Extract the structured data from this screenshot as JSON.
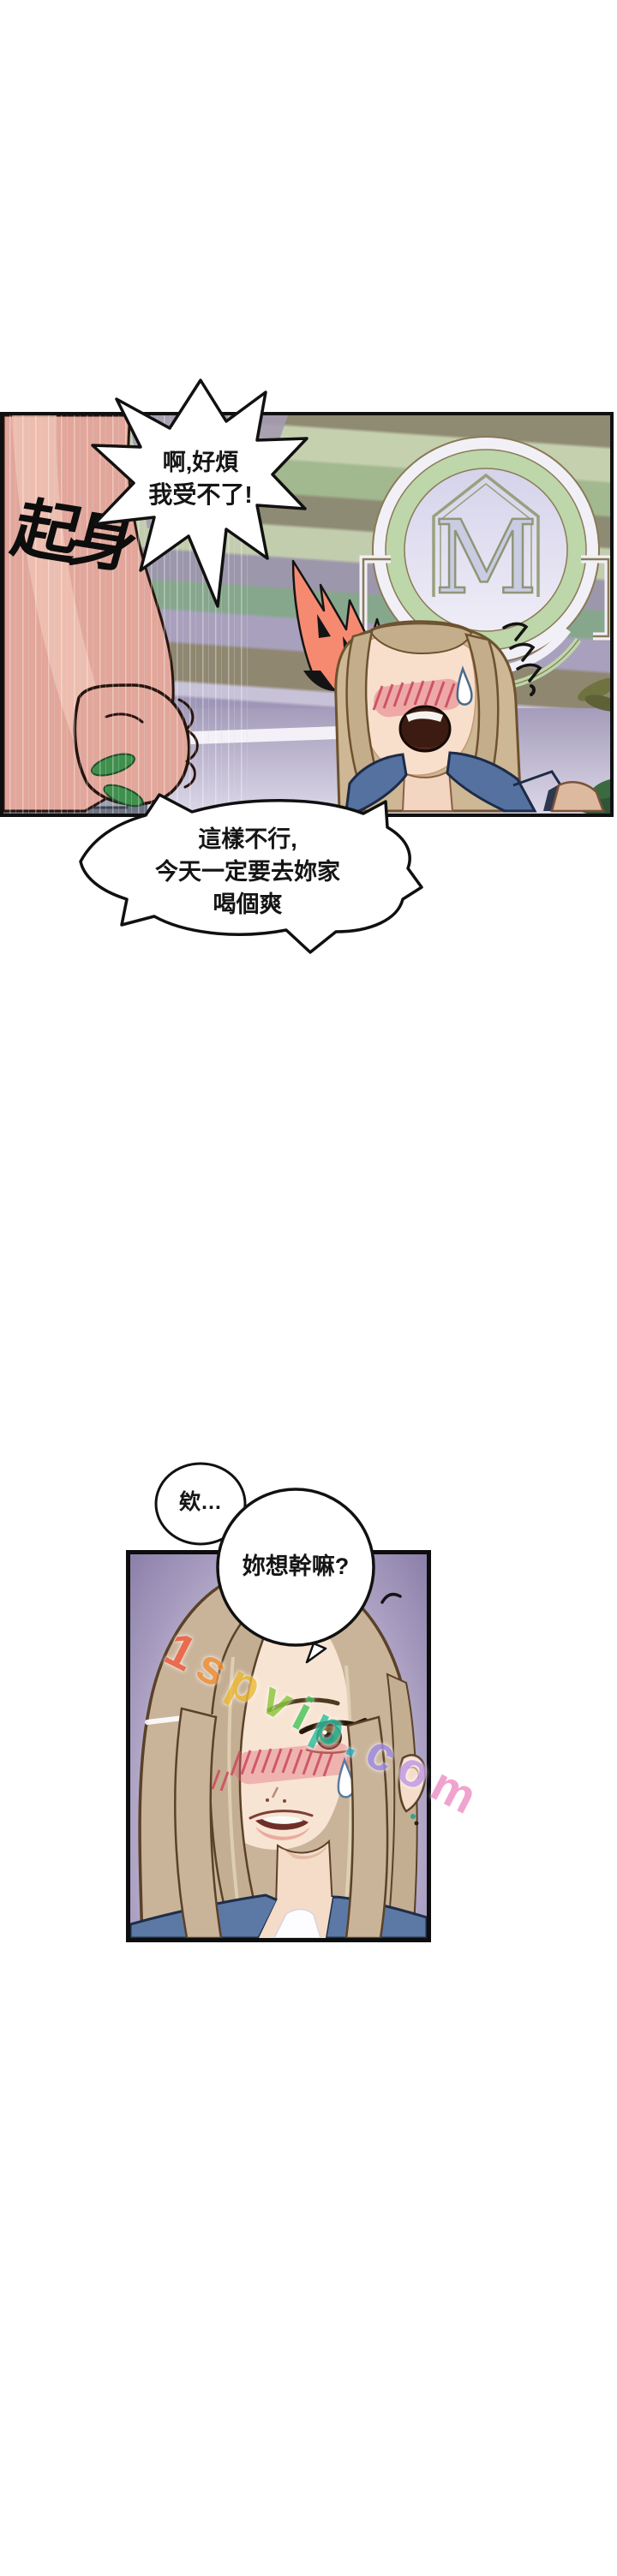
{
  "comic": {
    "sfx_standup": "起身",
    "shout_bubble": {
      "line1": "啊,好煩",
      "line2": "我受不了!"
    },
    "demand_bubble": {
      "line1": "這樣不行,",
      "line2": "今天一定要去妳家",
      "line3": "喝個爽"
    },
    "eh_bubble": {
      "text": "欸…"
    },
    "question_bubble": {
      "text": "妳想幹嘛?"
    },
    "emblem": {
      "letter": "M"
    },
    "watermark": {
      "text": "1spvip.com",
      "letters": [
        {
          "ch": "1",
          "color": "#f25c3e"
        },
        {
          "ch": "s",
          "color": "#f2923c"
        },
        {
          "ch": "p",
          "color": "#edbb3a"
        },
        {
          "ch": "v",
          "color": "#8cc93e"
        },
        {
          "ch": "i",
          "color": "#49c55c"
        },
        {
          "ch": "p",
          "color": "#2fc0a0"
        },
        {
          "ch": ".",
          "color": "#2fb6c9"
        },
        {
          "ch": "c",
          "color": "#9f8ce8"
        },
        {
          "ch": "o",
          "color": "#c39ae8"
        },
        {
          "ch": "m",
          "color": "#ef90c5"
        }
      ]
    },
    "palette": {
      "flame": "#f68a70",
      "denim": "#5b79a4",
      "blush": "#e06a74",
      "hair": "#c9b49a",
      "emblem_green": "#bdd6aa",
      "emblem_lavender": "#d9d7ec"
    }
  }
}
